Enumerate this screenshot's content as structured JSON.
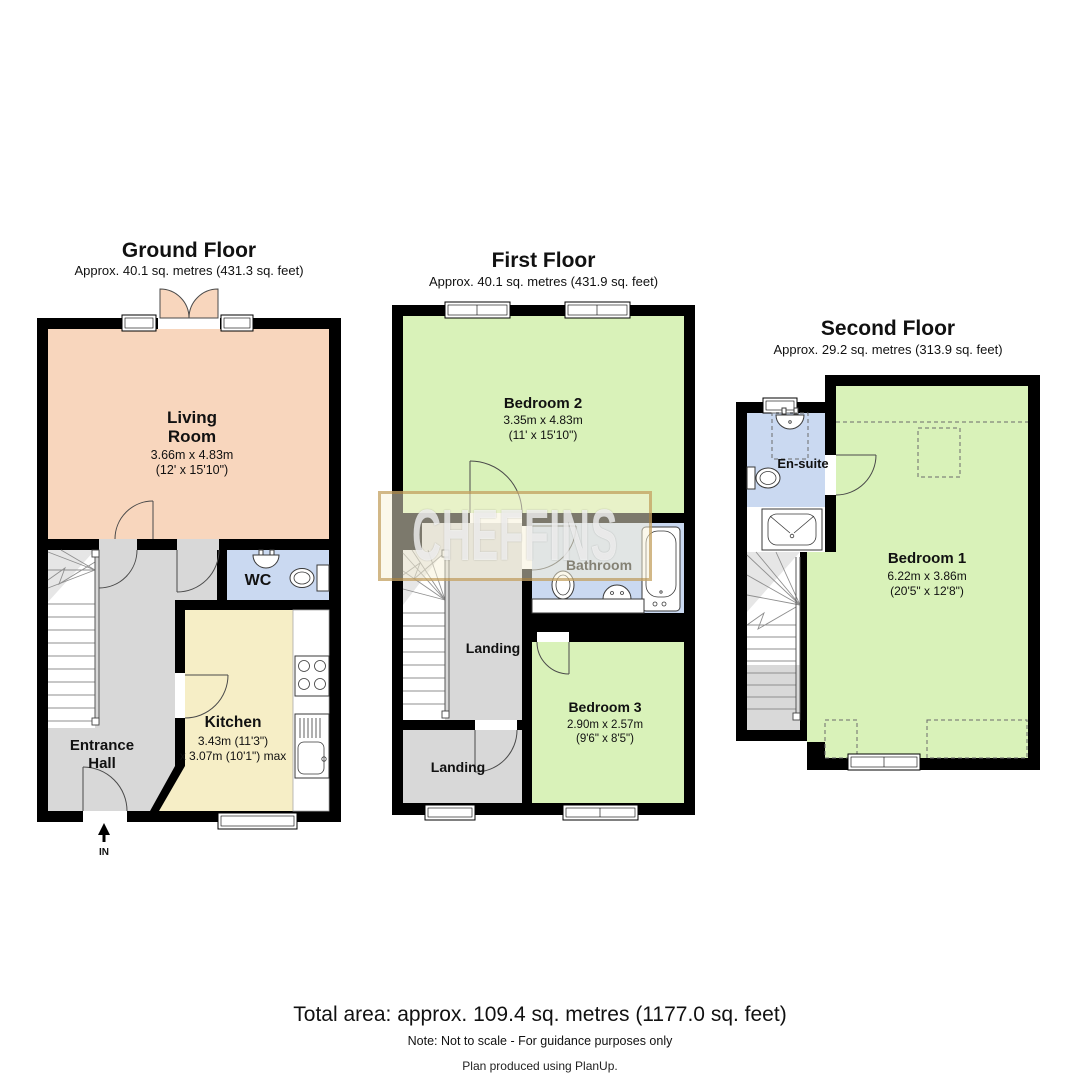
{
  "colors": {
    "wall": "#000000",
    "living": "#f8d6bd",
    "bedroom": "#d9f2b9",
    "wet": "#cad9f1",
    "kitchen": "#f6eec6",
    "hall": "#d8d8d8",
    "watermark_bg": "rgba(247,241,216,0.5)",
    "watermark_border": "rgba(176,132,53,0.55)",
    "watermark_text": "rgba(255,255,255,0.72)"
  },
  "watermark": {
    "text": "CHEFFINS"
  },
  "floors": {
    "ground": {
      "title": "Ground Floor",
      "subtitle": "Approx. 40.1 sq. metres (431.3 sq. feet)",
      "living": {
        "line1": "Living",
        "line2": "Room",
        "dims1": "3.66m x 4.83m",
        "dims2": "(12' x 15'10\")"
      },
      "wc": {
        "name": "WC"
      },
      "kitchen": {
        "name": "Kitchen",
        "dims1": "3.43m (11'3\")",
        "dims2": "x 3.07m (10'1\") max"
      },
      "hall": {
        "line1": "Entrance",
        "line2": "Hall"
      },
      "entry": {
        "label": "IN"
      }
    },
    "first": {
      "title": "First Floor",
      "subtitle": "Approx. 40.1 sq. metres (431.9 sq. feet)",
      "bedroom2": {
        "name": "Bedroom 2",
        "dims1": "3.35m x 4.83m",
        "dims2": "(11' x 15'10\")"
      },
      "bathroom": {
        "name": "Bathroom"
      },
      "landing_upper": {
        "name": "Landing"
      },
      "landing_lower": {
        "name": "Landing"
      },
      "bedroom3": {
        "name": "Bedroom 3",
        "dims1": "2.90m x 2.57m",
        "dims2": "(9'6\" x 8'5\")"
      }
    },
    "second": {
      "title": "Second Floor",
      "subtitle": "Approx. 29.2 sq. metres (313.9 sq. feet)",
      "ensuite": {
        "name": "En-suite"
      },
      "bedroom1": {
        "name": "Bedroom 1",
        "dims1": "6.22m x 3.86m",
        "dims2": "(20'5\" x 12'8\")"
      }
    }
  },
  "footer": {
    "total": "Total area: approx. 109.4 sq. metres (1177.0 sq. feet)",
    "note": "Note: Not to scale - For guidance purposes only",
    "producer": "Plan produced using PlanUp."
  }
}
